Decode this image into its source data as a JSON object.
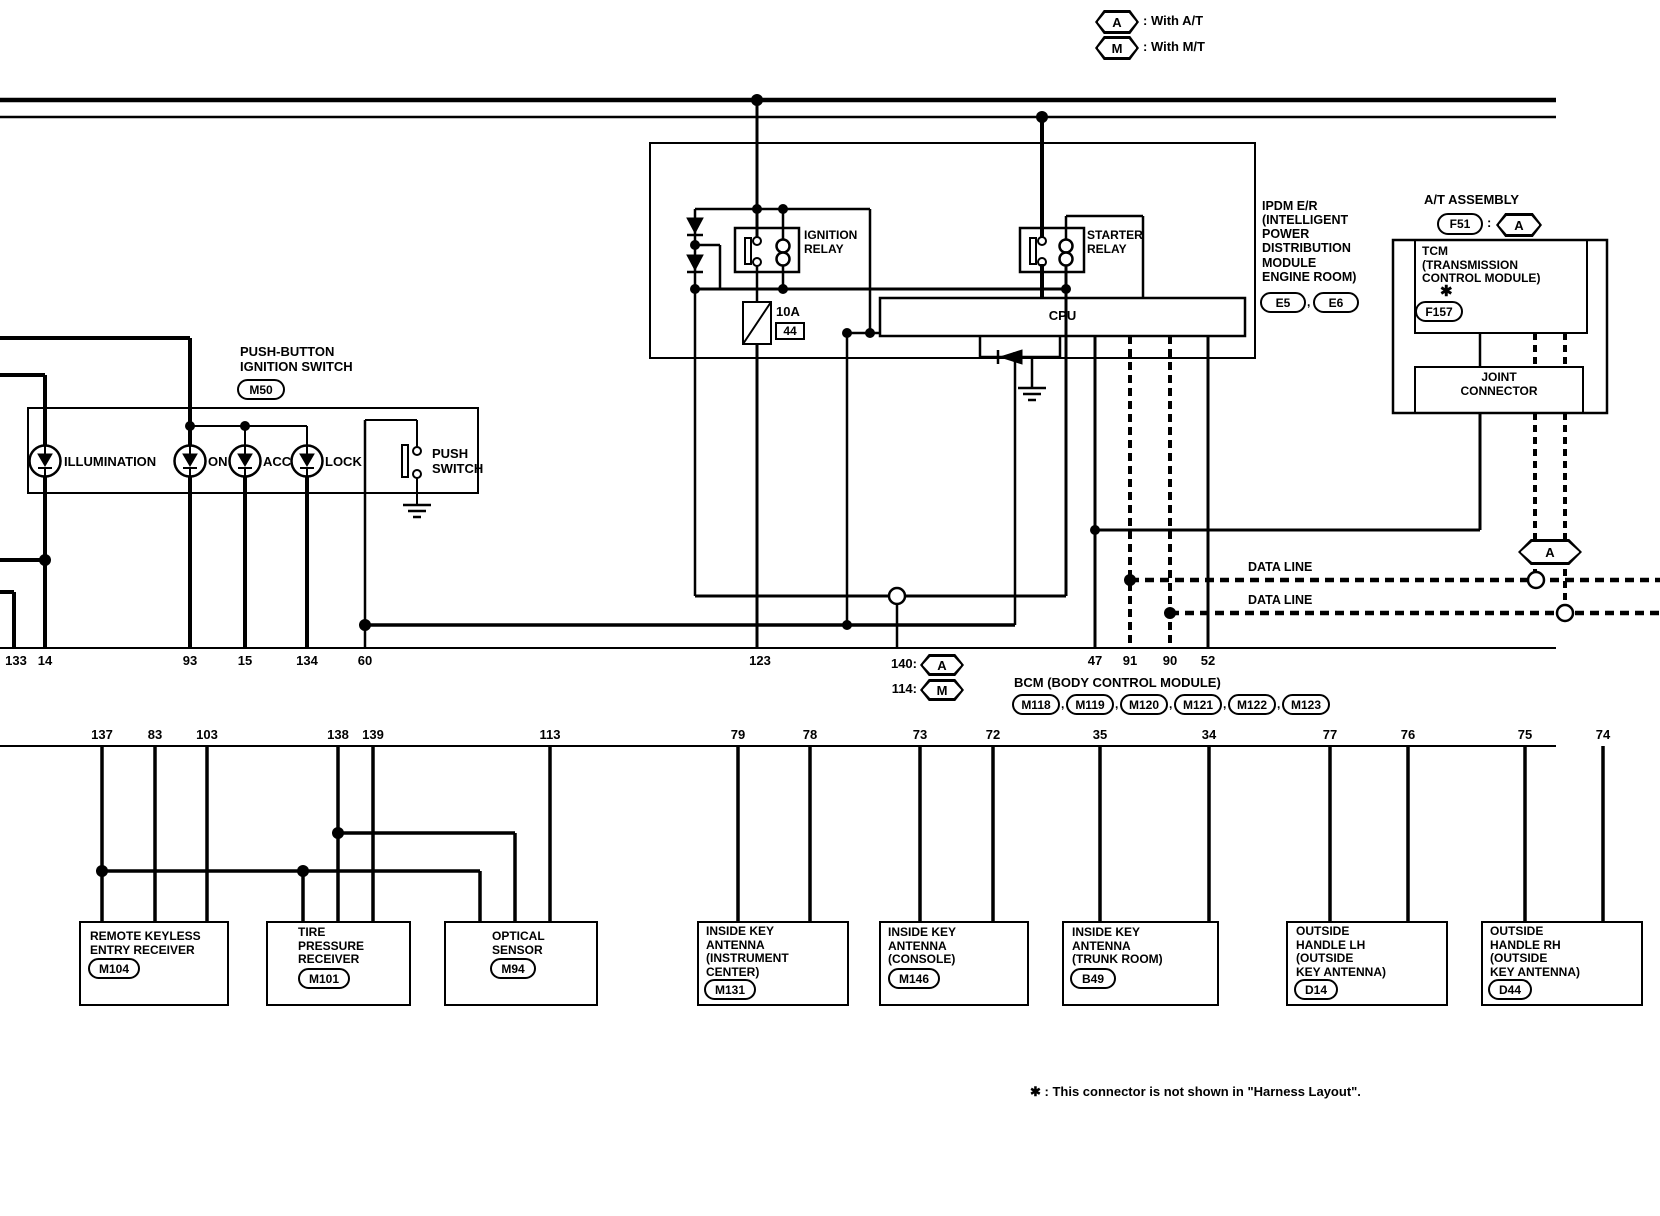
{
  "symbols": {
    "a": "A",
    "m": "M",
    "comma": ",",
    "colon": ":",
    "star": "✱"
  },
  "legend": {
    "at_label": ": With A/T",
    "mt_label": ": With M/T"
  },
  "ipdm": {
    "name": "IPDM E/R\n(INTELLIGENT\n POWER\n DISTRIBUTION\n MODULE\n ENGINE ROOM)",
    "connector1": "E5",
    "connector2": "E6",
    "ignition_relay": "IGNITION\nRELAY",
    "starter_relay": "STARTER\nRELAY",
    "cpu": "CPU",
    "fuse_rating": "10A",
    "fuse_number": "44"
  },
  "at_assembly": {
    "title": "A/T ASSEMBLY",
    "connector": "F51",
    "tcm": "TCM\n(TRANSMISSION\n CONTROL MODULE)",
    "tcm_connector": "F157",
    "joint": "JOINT\nCONNECTOR",
    "data_line1": "DATA LINE",
    "data_line2": "DATA LINE"
  },
  "ignition_switch": {
    "title": "PUSH-BUTTON\nIGNITION SWITCH",
    "connector": "M50",
    "led1": "ILLUMINATION",
    "led2": "ON",
    "led3": "ACC",
    "led4": "LOCK",
    "push": "PUSH\nSWITCH"
  },
  "bcm": {
    "title": "BCM (BODY CONTROL MODULE)",
    "connectors": [
      "M118",
      "M119",
      "M120",
      "M121",
      "M122",
      "M123"
    ],
    "pin140": "140:",
    "pin114": "114:"
  },
  "pins_bcm": [
    "133",
    "14",
    "93",
    "15",
    "134",
    "60",
    "123",
    "47",
    "91",
    "90",
    "52"
  ],
  "pins_bottom": [
    "137",
    "83",
    "103",
    "138",
    "139",
    "113",
    "79",
    "78",
    "73",
    "72",
    "35",
    "34",
    "77",
    "76",
    "75",
    "74"
  ],
  "components": [
    {
      "name": "REMOTE KEYLESS\nENTRY RECEIVER",
      "connector": "M104"
    },
    {
      "name": "TIRE\nPRESSURE\nRECEIVER",
      "connector": "M101"
    },
    {
      "name": "OPTICAL\nSENSOR",
      "connector": "M94"
    },
    {
      "name": "INSIDE KEY\nANTENNA\n(INSTRUMENT\nCENTER)",
      "connector": "M131"
    },
    {
      "name": "INSIDE KEY\nANTENNA\n(CONSOLE)",
      "connector": "M146"
    },
    {
      "name": "INSIDE KEY\nANTENNA\n(TRUNK ROOM)",
      "connector": "B49"
    },
    {
      "name": "OUTSIDE\nHANDLE LH\n(OUTSIDE\n KEY ANTENNA)",
      "connector": "D14"
    },
    {
      "name": "OUTSIDE\nHANDLE RH\n(OUTSIDE\n KEY ANTENNA)",
      "connector": "D44"
    }
  ],
  "footnote": "✱ : This connector is not shown in \"Harness Layout\"."
}
